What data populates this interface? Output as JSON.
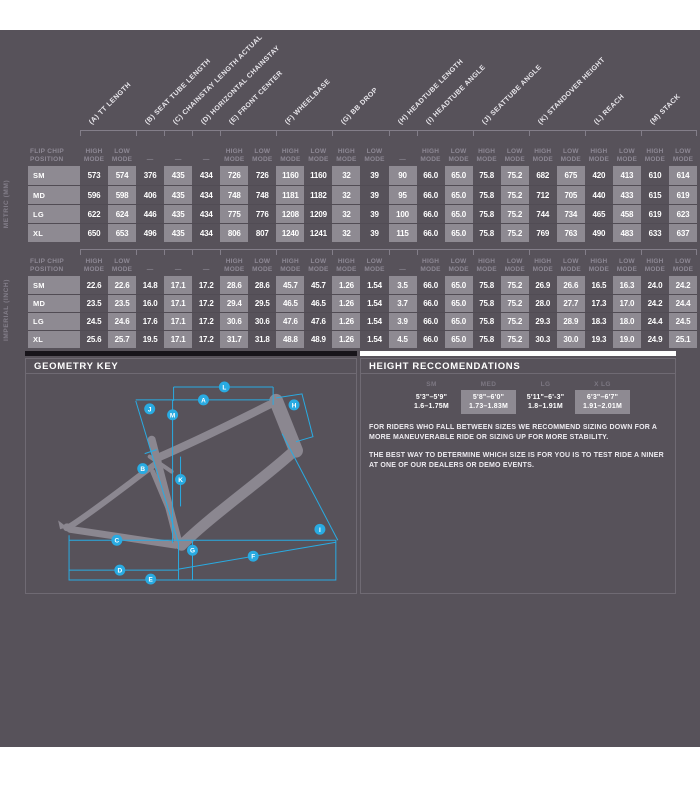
{
  "colors": {
    "accent_cyan": "#29ABE2",
    "canvas_bg": "#57525A",
    "shaded_cell": "#8E8A92"
  },
  "tables": {
    "row_header": "FLIP CHIP POSITION",
    "mode_high": "HIGH MODE",
    "mode_low": "LOW MODE",
    "mode_none": "—",
    "measurements": [
      {
        "letter": "A",
        "label": "(A) TT LENGTH",
        "modes": 2
      },
      {
        "letter": "B",
        "label": "(B) SEAT TUBE LENGTH",
        "modes": 1
      },
      {
        "letter": "C",
        "label": "(C) CHAINSTAY LENGTH ACTUAL",
        "modes": 1
      },
      {
        "letter": "D",
        "label": "(D) HORIZONTAL CHAINSTAY",
        "modes": 1
      },
      {
        "letter": "E",
        "label": "(E) FRONT CENTER",
        "modes": 2
      },
      {
        "letter": "F",
        "label": "(F) WHEELBASE",
        "modes": 2
      },
      {
        "letter": "G",
        "label": "(G) BB DROP",
        "modes": 2
      },
      {
        "letter": "H",
        "label": "(H) HEADTUBE LENGTH",
        "modes": 1
      },
      {
        "letter": "I",
        "label": "(I) HEADTUBE ANGLE",
        "modes": 2
      },
      {
        "letter": "J",
        "label": "(J) SEATTUBE ANGLE",
        "modes": 2
      },
      {
        "letter": "K",
        "label": "(K) STANDOVER HEIGHT",
        "modes": 2
      },
      {
        "letter": "L",
        "label": "(L) REACH",
        "modes": 2
      },
      {
        "letter": "M",
        "label": "(M) STACK",
        "modes": 2
      }
    ],
    "metric": {
      "unit_label": "METRIC (MM)",
      "rows": [
        {
          "size": "SM",
          "values": [
            "573",
            "574",
            "376",
            "435",
            "434",
            "726",
            "726",
            "1160",
            "1160",
            "32",
            "39",
            "90",
            "66.0",
            "65.0",
            "75.8",
            "75.2",
            "682",
            "675",
            "420",
            "413",
            "610",
            "614"
          ]
        },
        {
          "size": "MD",
          "values": [
            "596",
            "598",
            "406",
            "435",
            "434",
            "748",
            "748",
            "1181",
            "1182",
            "32",
            "39",
            "95",
            "66.0",
            "65.0",
            "75.8",
            "75.2",
            "712",
            "705",
            "440",
            "433",
            "615",
            "619"
          ]
        },
        {
          "size": "LG",
          "values": [
            "622",
            "624",
            "446",
            "435",
            "434",
            "775",
            "776",
            "1208",
            "1209",
            "32",
            "39",
            "100",
            "66.0",
            "65.0",
            "75.8",
            "75.2",
            "744",
            "734",
            "465",
            "458",
            "619",
            "623"
          ]
        },
        {
          "size": "XL",
          "values": [
            "650",
            "653",
            "496",
            "435",
            "434",
            "806",
            "807",
            "1240",
            "1241",
            "32",
            "39",
            "115",
            "66.0",
            "65.0",
            "75.8",
            "75.2",
            "769",
            "763",
            "490",
            "483",
            "633",
            "637"
          ]
        }
      ]
    },
    "imperial": {
      "unit_label": "IMPERIAL (INCH)",
      "rows": [
        {
          "size": "SM",
          "values": [
            "22.6",
            "22.6",
            "14.8",
            "17.1",
            "17.2",
            "28.6",
            "28.6",
            "45.7",
            "45.7",
            "1.26",
            "1.54",
            "3.5",
            "66.0",
            "65.0",
            "75.8",
            "75.2",
            "26.9",
            "26.6",
            "16.5",
            "16.3",
            "24.0",
            "24.2"
          ]
        },
        {
          "size": "MD",
          "values": [
            "23.5",
            "23.5",
            "16.0",
            "17.1",
            "17.2",
            "29.4",
            "29.5",
            "46.5",
            "46.5",
            "1.26",
            "1.54",
            "3.7",
            "66.0",
            "65.0",
            "75.8",
            "75.2",
            "28.0",
            "27.7",
            "17.3",
            "17.0",
            "24.2",
            "24.4"
          ]
        },
        {
          "size": "LG",
          "values": [
            "24.5",
            "24.6",
            "17.6",
            "17.1",
            "17.2",
            "30.6",
            "30.6",
            "47.6",
            "47.6",
            "1.26",
            "1.54",
            "3.9",
            "66.0",
            "65.0",
            "75.8",
            "75.2",
            "29.3",
            "28.9",
            "18.3",
            "18.0",
            "24.4",
            "24.5"
          ]
        },
        {
          "size": "XL",
          "values": [
            "25.6",
            "25.7",
            "19.5",
            "17.1",
            "17.2",
            "31.7",
            "31.8",
            "48.8",
            "48.9",
            "1.26",
            "1.54",
            "4.5",
            "66.0",
            "65.0",
            "75.8",
            "75.2",
            "30.3",
            "30.0",
            "19.3",
            "19.0",
            "24.9",
            "25.1"
          ]
        }
      ]
    }
  },
  "geometry_key": {
    "title": "GEOMETRY KEY",
    "markers": [
      "A",
      "B",
      "C",
      "D",
      "E",
      "F",
      "G",
      "H",
      "I",
      "J",
      "K",
      "L",
      "M"
    ]
  },
  "height_recommendations": {
    "title": "HEIGHT RECCOMENDATIONS",
    "columns": [
      {
        "label": "SM",
        "feet": "5'3\"–5'9\"",
        "meters": "1.6–1.75M",
        "shaded": false
      },
      {
        "label": "MED",
        "feet": "5'8\"–6'0\"",
        "meters": "1.73–1.83M",
        "shaded": true
      },
      {
        "label": "LG",
        "feet": "5'11\"–6'-3\"",
        "meters": "1.8–1.91M",
        "shaded": false
      },
      {
        "label": "X LG",
        "feet": "6'3\"–6'7\"",
        "meters": "1.91–2.01M",
        "shaded": true
      }
    ],
    "paragraphs": [
      "FOR RIDERS WHO FALL BETWEEN SIZES WE RECOMMEND SIZING DOWN FOR A MORE MANEUVERABLE RIDE OR SIZING UP FOR MORE STABILITY.",
      "THE BEST WAY TO DETERMINE WHICH SIZE IS FOR YOU IS TO TEST RIDE A NINER AT ONE OF OUR DEALERS OR DEMO EVENTS."
    ]
  }
}
